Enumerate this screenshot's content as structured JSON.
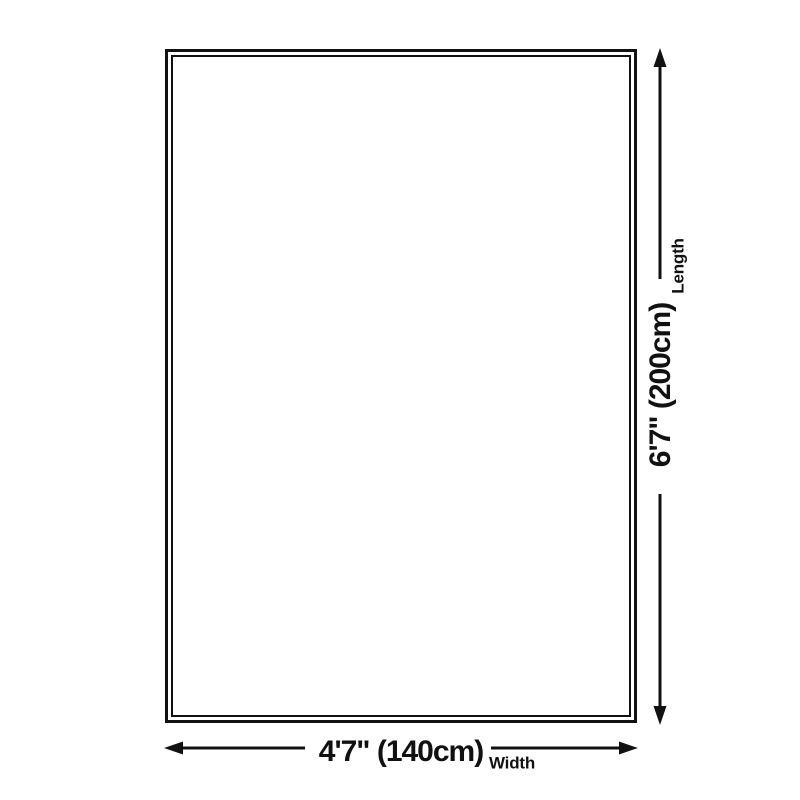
{
  "diagram": {
    "length": {
      "value": "6'7\" (200cm)",
      "label": "Length"
    },
    "width": {
      "value": "4'7\" (140cm)",
      "label": "Width"
    },
    "line_color": "#111111",
    "background_color": "#ffffff"
  }
}
